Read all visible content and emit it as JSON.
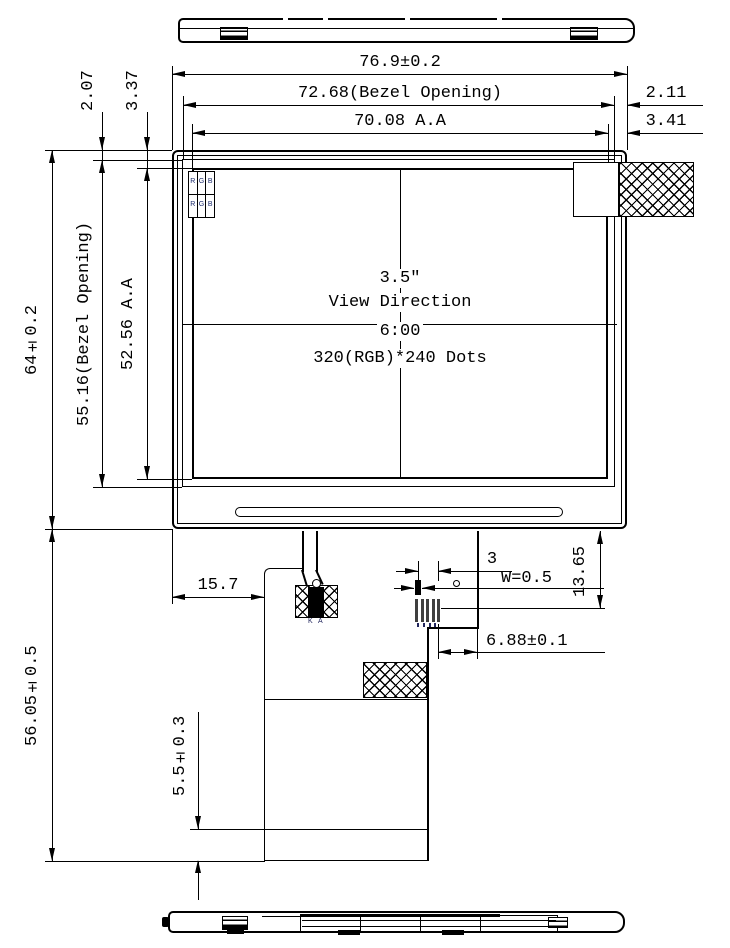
{
  "annotations": {
    "width_overall": "76.9±0.2",
    "width_bezel_opening": "72.68(Bezel Opening)",
    "width_active_area": "70.08 A.A",
    "margin_right_bezel": "2.11",
    "margin_right_active_area": "3.41",
    "margin_top_bezel": "2.07",
    "margin_top_active_area": "3.37",
    "height_overall": "64±0.2",
    "height_bezel_opening": "55.16(Bezel Opening)",
    "height_active_area": "52.56 A.A",
    "height_below_panel": "56.05±0.5",
    "fpc_offset_left": "15.7",
    "pin_offset": "3",
    "trace_width": "W=0.5",
    "fpc_offset_right": "6.88±0.1",
    "fpc_drop_height": "13.65",
    "tail_fold_length": "5.5±0.3"
  },
  "panel_label": {
    "diagonal_size": "3.5″",
    "view_direction_label": "View Direction",
    "view_direction_value": "6:00",
    "resolution": "320(RGB)*240 Dots"
  },
  "pixels": {
    "r": "R",
    "g": "G",
    "b": "B"
  },
  "led": {
    "cathode": "K",
    "anode": "A"
  }
}
